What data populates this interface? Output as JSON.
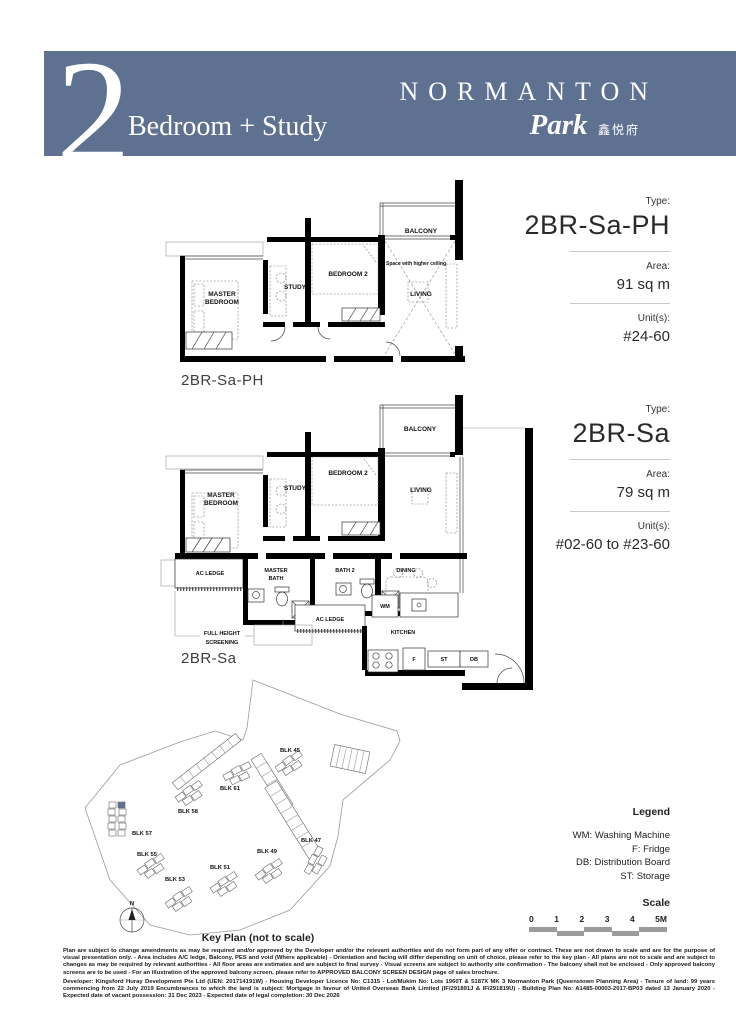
{
  "header": {
    "number": "2",
    "subtitle": "Bedroom + Study",
    "brand": "NORMANTON",
    "brand_script": "Park",
    "brand_cn": "鑫悦府"
  },
  "panels": [
    {
      "type_label": "Type:",
      "type": "2BR-Sa-PH",
      "area_label": "Area:",
      "area": "91 sq m",
      "units_label": "Unit(s):",
      "units": "#24-60"
    },
    {
      "type_label": "Type:",
      "type": "2BR-Sa",
      "area_label": "Area:",
      "area": "79 sq m",
      "units_label": "Unit(s):",
      "units": "#02-60 to #23-60"
    }
  ],
  "plans": {
    "ph": {
      "name": "2BR-Sa-PH",
      "rooms": {
        "master1": "MASTER",
        "master2": "BEDROOM",
        "study": "STUDY",
        "bedroom2": "BEDROOM 2",
        "balcony": "BALCONY",
        "living": "LIVING",
        "higher_ceiling": "Space with higher ceiling"
      }
    },
    "sa": {
      "name": "2BR-Sa",
      "rooms": {
        "master1": "MASTER",
        "master2": "BEDROOM",
        "study": "STUDY",
        "bedroom2": "BEDROOM 2",
        "balcony": "BALCONY",
        "living": "LIVING",
        "ac_ledge1": "AC LEDGE",
        "master_bath1": "MASTER",
        "master_bath2": "BATH",
        "bath2": "BATH 2",
        "dining": "DINING",
        "ac_ledge2": "AC LEDGE",
        "wm": "WM",
        "kitchen": "KITCHEN",
        "fridge": "F",
        "st": "ST",
        "db": "DB",
        "fhs1": "FULL HEIGHT",
        "fhs2": "SCREENING"
      }
    }
  },
  "keyplan": {
    "title": "Key Plan (not to scale)",
    "north": "N",
    "blocks": [
      "BLK 45",
      "BLK 61",
      "BLK 58",
      "BLK 57",
      "BLK 55",
      "BLK 53",
      "BLK 51",
      "BLK 49",
      "BLK 47"
    ]
  },
  "legend": {
    "title": "Legend",
    "items": [
      "WM: Washing Machine",
      "F: Fridge",
      "DB: Distribution Board",
      "ST: Storage"
    ]
  },
  "scale": {
    "title": "Scale",
    "ticks": [
      "0",
      "1",
      "2",
      "3",
      "4",
      "5M"
    ]
  },
  "disclaimer": {
    "p1": "Plan are subject to change amendments as may be required and/or approved by the Developer and/or the relevant authorities and do not form part of any offer or contract. These are not drawn to scale and are for the purpose of visual presentation only. - Area includes A/C ledge, Balcony, PES and void (Where applicable) - Orientation and facing will differ depending on unit of choice, please refer to the key plan - All plans are not to scale and are subject to changes as may be required by relevant authorities - All floor areas are estimates and are subject to final survey - Visual screens are subject to authority site confirmation - The balcony shall not be enclosed - Only approved balcony screens are to be used - For an illustration of the approved balcony screen, please refer to APPROVED BALCONY SCREEN DESIGN page of sales brochure.",
    "p2": "Developer: Kingsford Huray Development Pte Ltd (UEN: 201714191W) - Housing Developer Licence No: C1315 - Lot/Mukim No: Lots 1960T & 5187X MK 3 Normanton Park (Queenstown Planning Area) - Tenure of land: 99 years commencing from 22 July 2019 Encumbrances to which the land is subject: Mortgage in favour of United Overseas Bank Limited (IF/291891J & IF/291819U) - Building Plan No: A1485-00003-2017-BP03 dated 13 January 2020 - Expected date of vacant possession: 31 Dec 2023 - Expected date of legal completion: 30 Dec 2026"
  },
  "colors": {
    "band": "#5e7190",
    "highlight": "#5e7190",
    "scale_bar": "#9b9b9b"
  }
}
